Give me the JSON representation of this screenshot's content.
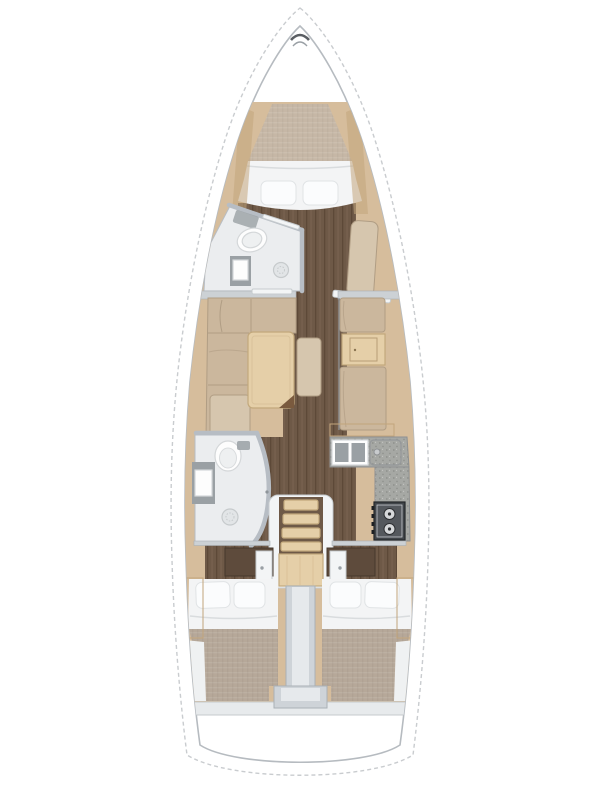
{
  "meta": {
    "title": "Sailing yacht interior layout — top-down floor plan",
    "canvas": {
      "width": 600,
      "height": 800
    }
  },
  "colors": {
    "page_bg": "#ffffff",
    "hull_fill": "#ffffff",
    "hull_outline": "#c9cccf",
    "inner_wall": "#b6bbc0",
    "wood_trim": "#d6bd9c",
    "wood_trim_dark": "#c2a57c",
    "floor_planks": "#6e5947",
    "floor_plank_line": "#5d4938",
    "floor_plank_hi": "#7c6553",
    "cushion": "#cbb79d",
    "cushion_line": "#b09d84",
    "seat_beige": "#d6c6ae",
    "table_wood": "#e5cfa8",
    "table_edge": "#c2a87c",
    "table_corner": "#7a5a3e",
    "mattress_fwd": "#c6b7a6",
    "mattress_aft": "#b6a899",
    "bedding_white": "#f3f4f5",
    "pillow_white": "#fbfcfd",
    "pillow_edge": "#e0e3e5",
    "bath_floor": "#ebedef",
    "bath_wall": "#b7bdc4",
    "fixture_white": "#fdfdfd",
    "fixture_edge": "#d4d7d9",
    "counter_gray": "#a6a8a4",
    "counter_speck": "#8e908c",
    "sink_basin": "#9aa0a4",
    "stove_body": "#41454a",
    "stove_panel": "#54585d",
    "burner": "#d6d8da",
    "burner_dot": "#2e3033",
    "engine_box": "#ced3d8",
    "engine_box_hi": "#e6e9ec",
    "wardrobe_wood": "#5e4b3c",
    "door_white": "#f3f5f6",
    "door_edge": "#c7cccf",
    "shelf_gray": "#e7eaec",
    "wall_gray": "#ccd1d5"
  },
  "regions": {
    "bow_locker": {
      "label": "bow anchor locker"
    },
    "forward_cabin": {
      "label": "forward cabin V-berth",
      "pillow_count": 2
    },
    "forward_head": {
      "label": "forward head: toilet, sink, shower"
    },
    "saloon": {
      "label": "saloon with L-shaped settee and folding table"
    },
    "starboard_dinette": {
      "label": "starboard facing seats with table"
    },
    "galley": {
      "label": "L-shaped galley",
      "sink_basins": 2,
      "burner_count": 2
    },
    "aft_head": {
      "label": "aft head: toilet, sink, shower"
    },
    "companionway": {
      "label": "companionway stairs",
      "step_count": 4
    },
    "aft_cabin_port": {
      "label": "port aft cabin double berth",
      "pillow_count": 2
    },
    "aft_cabin_starboard": {
      "label": "starboard aft cabin double berth",
      "pillow_count": 2
    },
    "engine_compartment": {
      "label": "engine compartment between aft cabins"
    },
    "stern": {
      "label": "stern transom"
    }
  }
}
